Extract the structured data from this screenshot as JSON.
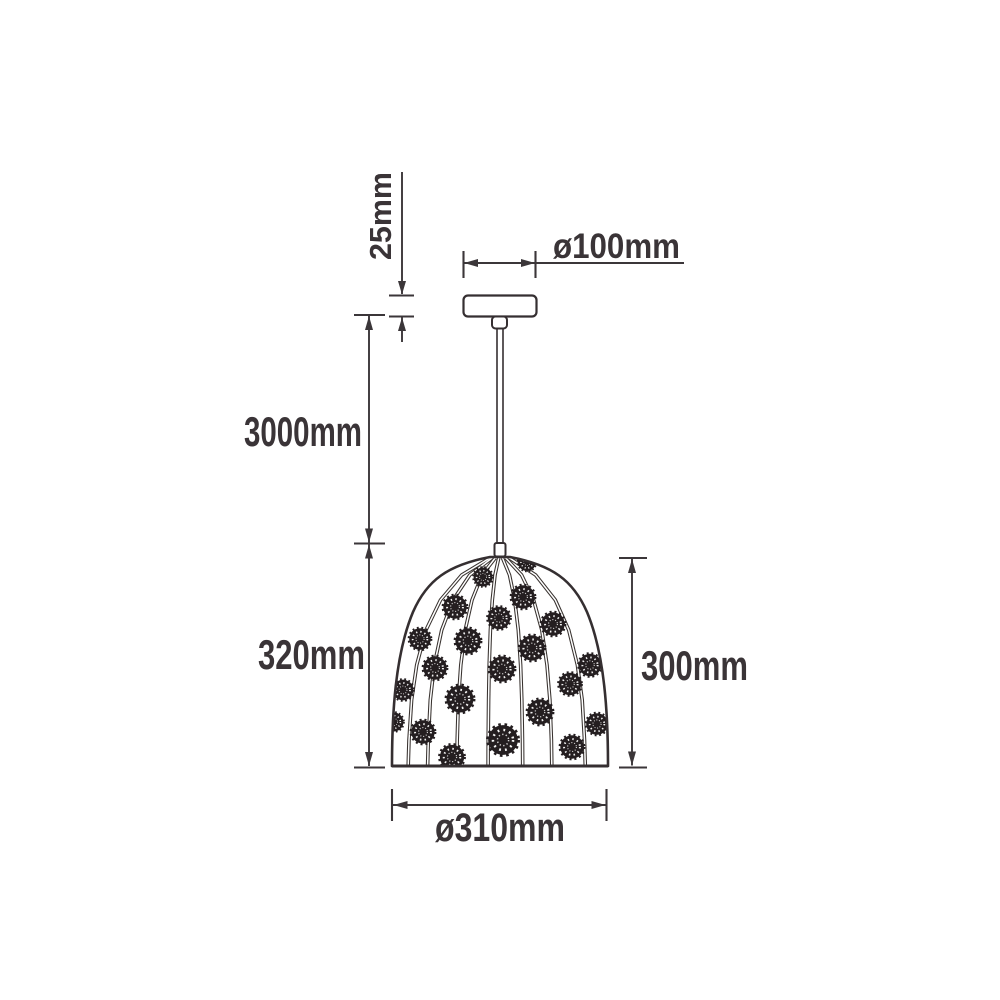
{
  "diagram": {
    "subject": "pendant-lamp-dimension-drawing",
    "dimensions": {
      "canopy_height": "25mm",
      "canopy_diameter": "ø100mm",
      "suspension_length": "3000mm",
      "drop_section_left": "320mm",
      "shade_height": "300mm",
      "shade_diameter": "ø310mm"
    },
    "colors": {
      "line": "#3b3639",
      "text": "#3a3437",
      "pattern": "#241e20",
      "background": "#ffffff"
    }
  }
}
